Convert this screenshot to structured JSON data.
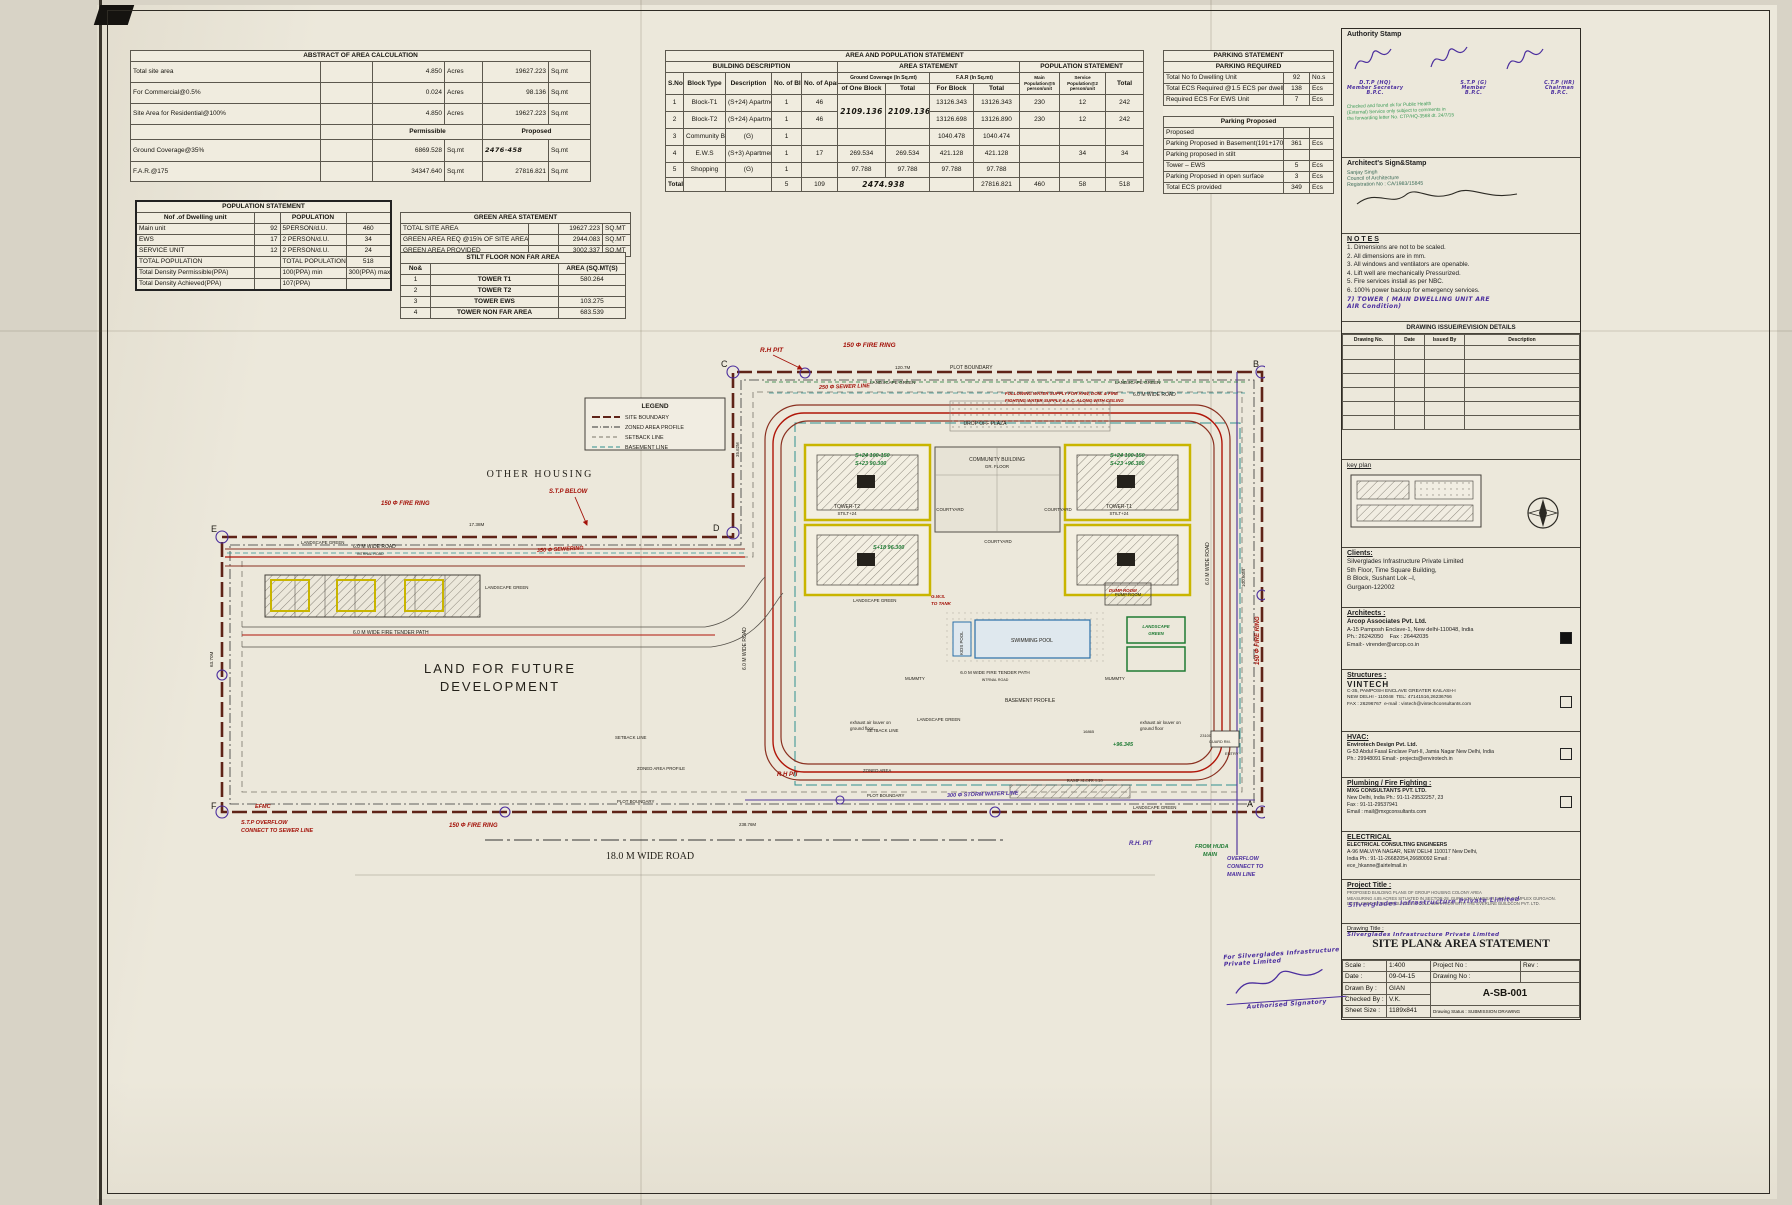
{
  "abstract": {
    "title": "ABSTRACT OF AREA CALCULATION",
    "perm": "Permissible",
    "prop": "Proposed",
    "rows": [
      {
        "label": "Total site area",
        "v1": "4.850",
        "u1": "Acres",
        "v2": "19627.223",
        "u2": "Sq.mt"
      },
      {
        "label": "For Commercial@0.5%",
        "v1": "0.024",
        "u1": "Acres",
        "v2": "98.136",
        "u2": "Sq.mt"
      },
      {
        "label": "Site Area for Residential@100%",
        "v1": "4.850",
        "u1": "Acres",
        "v2": "19627.223",
        "u2": "Sq.mt"
      }
    ],
    "rows2": [
      {
        "label": "Ground Coverage@35%",
        "perm": "6869.528",
        "u1": "Sq.mt",
        "prop": "2476·458",
        "u2": "Sq.mt"
      },
      {
        "label": "F.A.R.@175",
        "perm": "34347.640",
        "u1": "Sq.mt",
        "prop": "27816.821",
        "u2": "Sq.mt"
      }
    ]
  },
  "ap": {
    "title": "AREA AND POPULATION STATEMENT",
    "g1": "BUILDING DESCRIPTION",
    "g2": "AREA STATEMENT",
    "g3": "POPULATION STATEMENT",
    "h": {
      "sno": "S.No.",
      "block": "Block Type",
      "desc": "Description",
      "nblock": "No. of Block",
      "napt": "No. of Apartment",
      "gc": "Ground Coverage (In Sq.mt)",
      "gc1": "of One Block",
      "gc2": "Total",
      "far": "F.A.R (In Sq.mt)",
      "far1": "For Block",
      "far2": "Total",
      "pop1": "Main Population@5 person/unit",
      "pop2": "Service Population@2 person/unit",
      "pop3": "Total"
    },
    "rows": [
      [
        "1",
        "Block-T1",
        "(S+24) Apartment",
        "1",
        "46",
        "2109.136",
        "2109.136",
        "13126.343",
        "13126.343",
        "230",
        "12",
        "242"
      ],
      [
        "2",
        "Block-T2",
        "(S+24) Apartment",
        "1",
        "46",
        "",
        "",
        "13126.698",
        "13126.890",
        "230",
        "12",
        "242"
      ],
      [
        "3",
        "Community Building",
        "(G)",
        "1",
        "",
        "",
        "",
        "1040.478",
        "1040.474",
        "",
        "",
        ""
      ],
      [
        "4",
        "E.W.S",
        "(S+3) Apartment",
        "1",
        "17",
        "269.534",
        "269.534",
        "421.128",
        "421.128",
        "",
        "34",
        "34"
      ],
      [
        "5",
        "Shopping",
        "(G)",
        "1",
        "",
        "97.788",
        "97.788",
        "97.788",
        "97.788",
        "",
        "",
        ""
      ],
      [
        "Total",
        "",
        "",
        "5",
        "109",
        "2474.938",
        "",
        "",
        "27816.821",
        "460",
        "58",
        "518"
      ]
    ]
  },
  "parking": {
    "title": "PARKING STATEMENT",
    "sub1": "PARKING REQUIRED",
    "sub2": "Parking Proposed",
    "req": [
      [
        "Total No fo Dwelling Unit",
        "92",
        "No.s"
      ],
      [
        "Total ECS Required @1.5 ECS per dwelling unit",
        "138",
        "Ecs"
      ],
      [
        "Required ECS For EWS Unit",
        "7",
        "Ecs"
      ]
    ],
    "prop": [
      [
        "Proposed",
        "",
        ""
      ],
      [
        "Parking Proposed in Basement(191+170)",
        "361",
        "Ecs"
      ],
      [
        "Parking proposed in stilt",
        "",
        ""
      ],
      [
        "Tower – EWS",
        "5",
        "Ecs"
      ],
      [
        "Parking Proposed in open surface",
        "3",
        "Ecs"
      ],
      [
        "Total ECS provided",
        "349",
        "Ecs"
      ]
    ]
  },
  "pop": {
    "title": "POPULATION STATEMENT",
    "h1": "Nof .of Dwelling unit",
    "h2": "POPULATION",
    "rows": [
      [
        "Main unit",
        "92",
        "5PERSON/d.U.",
        "460"
      ],
      [
        "EWS",
        "17",
        "2 PERSON/d.U.",
        "34"
      ],
      [
        "SERVICE UNIT",
        "12",
        "2 PERSON/d.U.",
        "24"
      ],
      [
        "TOTAL POPULATION",
        "",
        "TOTAL POPULATION",
        "518"
      ],
      [
        "Total Density Permissible(PPA)",
        "",
        "100(PPA) min",
        "300(PPA) max"
      ],
      [
        "Total Density Achieved(PPA)",
        "",
        "107(PPA)",
        ""
      ]
    ]
  },
  "green": {
    "title": "GREEN AREA STATEMENT",
    "rows": [
      [
        "TOTAL SITE AREA",
        "19627.223",
        "SQ.MT"
      ],
      [
        "GREEN AREA REQ @15% OF SITE AREA",
        "2944.083",
        "SQ.MT"
      ],
      [
        "GREEN AREA PROVIDED",
        "3002.337",
        "SQ.MT"
      ]
    ]
  },
  "stilt": {
    "title": "STILT FLOOR NON FAR AREA",
    "h1": "No&",
    "h2": "AREA (SQ.MT(S)",
    "rows": [
      [
        "1",
        "TOWER T1",
        "580.264"
      ],
      [
        "2",
        "TOWER T2",
        ""
      ],
      [
        "3",
        "TOWER EWS",
        "103.275"
      ],
      [
        "4",
        "TOWER NON FAR AREA",
        "683.539"
      ]
    ]
  },
  "plan": {
    "legend": {
      "title": "LEGEND",
      "items": [
        "SITE BOUNDARY",
        "ZONED AREA PROFILE",
        "SETBACK LINE",
        "BASEMENT LINE"
      ]
    },
    "corners": {
      "a": "A",
      "b": "B",
      "c": "C",
      "d": "D",
      "e": "E",
      "f": "F"
    },
    "labels": {
      "other_housing": "OTHER HOUSING",
      "land1": "LAND FOR FUTURE",
      "land2": "DEVELOPMENT",
      "road18": "18.0 M WIDE ROAD",
      "road6": "6.0 M WIDE ROAD",
      "internal": "INTRNAL ROAD",
      "tender": "6.0 M WIDE FIRE TENDER PATH",
      "landscape": "LANDSCAPE GREEN",
      "community": "COMMUNITY BUILDING",
      "grfloor": "GR. FLOOR",
      "courtyard": "COURTYARD",
      "tower_t2": "TOWER-T2",
      "tower_t1": "TOWER-T1",
      "stilt24": "STILT+24",
      "dropoff": "DROP OFF PLAZA",
      "swimming": "SWIMMING POOL",
      "kids": "KIDS POOL",
      "pump": "PUMP ROOM",
      "basement": "BASEMENT PROFILE",
      "setback": "SETBACK LINE",
      "zoned": "ZONED AREA PROFILE",
      "zoned2": "ZONED AREA",
      "plot": "PLOT BOUNDARY",
      "mummty": "MUMMTY",
      "louver1": "exhaust air louver on",
      "louver2": "ground floor",
      "guard": "GUARD RM.",
      "ramp": "RAMP SLOPE 1:20",
      "entry": "ENTRY",
      "d120": "120.7M",
      "d238": "238.76M",
      "d17": "17.38M",
      "d63": "63.70M",
      "d100": "100.60M",
      "d35": "35.62M",
      "d16865": "16865",
      "d23100": "23100"
    },
    "ann": {
      "rhpit": "R.H PIT",
      "ring": "150 Φ FIRE RING",
      "sewer250": "250 Φ SEWER LINE",
      "sewer350": "350 Φ SEWERING",
      "stp": "S.T.P BELOW",
      "ovf1": "S.T.P OVERFLOW",
      "ovf2": "CONNECT TO SEWER LINE",
      "efmc": "EFMC",
      "wn1": "FOLLOWING WATER SUPPLY FOR RAW, DOM. & FIRE",
      "wn2": "FIGHTING WATER SUPPLY & A.C. ALONG WITH CEILING",
      "gws1": "G.W.S.",
      "gws2": "TO TANK",
      "storm": "300 Φ STORM WATER LINE",
      "rhpit2": "R.H. PIT",
      "huda1": "FROM HUDA",
      "huda2": "MAIN",
      "ov1": "OVERFLOW",
      "ov2": "CONNECT TO",
      "ov3": "MAIN LINE",
      "dump": "DUMP ROOM",
      "s24": "S+24 100-150",
      "s23": "S+23 90.300",
      "s23b": "S+23 +96.300",
      "s18": "S+18 96.300",
      "s96": "+96.345",
      "lg1": "LANDSCAPE",
      "lg2": "GREEN"
    }
  },
  "panel": {
    "authority": {
      "label": "Authority Stamp",
      "sig1a": "D.T.P (HQ)",
      "sig1b": "Member Secretary",
      "sig1c": "B.P.C.",
      "sig2a": "S.T.P (G)",
      "sig2b": "Member",
      "sig2c": "B.P.C.",
      "sig3a": "C.T.P (HR)",
      "sig3b": "Chairman",
      "sig3c": "B.P.C.",
      "stamp1": "Checked and found ok for Public Health",
      "stamp2": "(External) Service only subject to comments in",
      "stamp3": "the forwarding letter No. CTP/HQ-3568 dt. 24/7/15"
    },
    "architect": {
      "label": "Architect's Sign&Stamp",
      "l1": "Sanjay Singh",
      "l2": "Council of Architecture",
      "l3": "Registration No : CA/1983/15845"
    },
    "notes": {
      "title": "N O T E S",
      "items": [
        "1. Dimensions are not to be scaled.",
        "2. All dimensions are in mm.",
        "3. All windows and ventilators are openable.",
        "4. Lift well are mechanically Pressurized.",
        "5. Fire services install as per NBC.",
        "6. 100% power backup for emergency services."
      ],
      "hw1": "7) TOWER ( MAIN DWELLING UNIT ARE",
      "hw2": "AIR Condition)"
    },
    "revision": {
      "title": "DRAWING ISSUE/REVISION DETAILS",
      "cols": [
        "Drawing No.",
        "Date",
        "Issued By",
        "Description"
      ]
    },
    "keyplan": {
      "label": "key plan"
    },
    "clients": {
      "title": "Clients:",
      "l1": "Silverglades Infrastructure Private Limited",
      "l2": "5th Floor, Time Square Building,",
      "l3": "B Block, Sushant Lok –I,",
      "l4": "Gurgaon-122002"
    },
    "architects": {
      "title": "Architects :",
      "l1": "Arcop Associates Pvt. Ltd.",
      "l2": "A-15 Pamposh Enclave-1, New delhi-110048, India",
      "l3": "Ph.: 26242050",
      "l3b": "Fax : 26442035",
      "l4": "Email:- virender@arcop.co.in"
    },
    "structures": {
      "title": "Structures :",
      "logo": "VINTECH",
      "l1": "C-35, PAMPOSH ENCLAVE GREATER KAILASH-I",
      "l2": "NEW DELHI - 110048",
      "l3": "TEL: 47141516,26236766",
      "l4": "FAX : 26296767",
      "l5": "e-mail : vintech@vintechconsultants.com"
    },
    "hvac": {
      "title": "HVAC:",
      "l1": "Envirotech Design Pvt. Ltd.",
      "l2": "G-53 Abdul Fasal Enclave Part-II, Jamia Nagar",
      "l3": "New Delhi, India",
      "l4": "Ph.: 29948091   Email:- projects@envirotech.in"
    },
    "plumbing": {
      "title": "Plumbing / Fire Fighting :",
      "l1": "MXG CONSULTANTS PVT. LTD.",
      "l2": "New Delhi, India Ph.: 91-11-29532257, 23",
      "l3": "Fax : 91-11-29537941",
      "l4": "Email : mail@mxgconsultants.com"
    },
    "electrical": {
      "title": "ELECTRICAL",
      "l1": "ELECTRICAL CONSULTING ENGINEERS",
      "l2": "A-96 MALVIYA NAGAR, NEW DELHI 110017 New Delhi,",
      "l3": "India Ph.: 91-11-26682054,26680092 Email :",
      "l4": "ece_hkanne@airtelmail.in"
    },
    "project": {
      "title": "Project Title :",
      "l1": "PROPOSED BUILDING PLANS OF GROUP HOUSING COLONY AREA",
      "l2": "MEASURING 4.85 ACRES SITUATED IN SECTOR-28,",
      "l3": "GURGAON MANESAR URBAN COMPLEX GURGAON.",
      "l4": "DEVELOPED BY SILVERGLADES IN COLLABORATION WITH",
      "l5": "THE EVERLINE BUILDCON PVT. LTD.",
      "stamp": "Silverglades Infrastructure Private Limited"
    },
    "drawing": {
      "label": "Drawing Title :",
      "stamp": "Silverglades Infrastructure Private Limited",
      "title": "SITE PLAN& AREA STATEMENT"
    },
    "info": {
      "scale_l": "Scale :",
      "scale": "1:400",
      "proj_l": "Project No :",
      "rev_l": "Rev :",
      "date_l": "Date :",
      "date": "09-04-15",
      "dno_l": "Drawing No :",
      "drawn_l": "Drawn By :",
      "drawn": "GIAN",
      "dno": "A-SB-001",
      "chk_l": "Checked By :",
      "chk": "V.K.",
      "size_l": "Sheet Size :",
      "size": "1189x841",
      "status_l": "Drawing Status :",
      "status": "SUBMISSION DRAWING"
    }
  },
  "stampbl": {
    "l1": "For Silverglades Infrastructure Private Limited",
    "l2": "Authorised Signatory"
  }
}
